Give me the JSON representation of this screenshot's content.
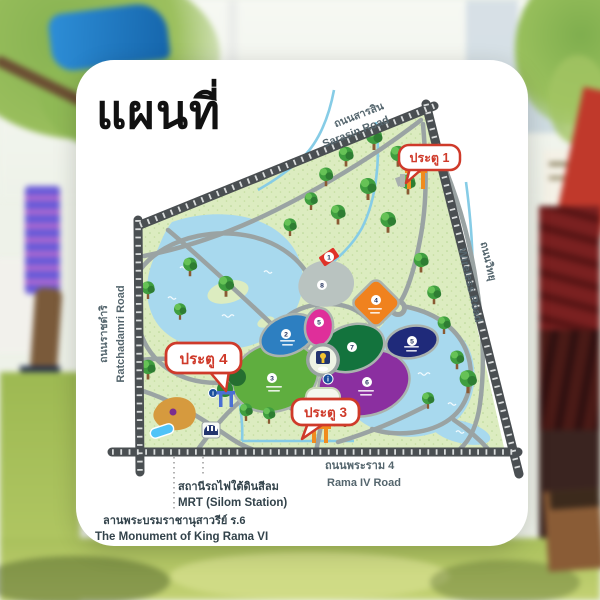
{
  "title": "แผนที่",
  "map": {
    "roads": {
      "sarasin_th": "ถนนสารสิน",
      "sarasin_en": "Sarasin Road",
      "wireless_th": "ถนนวิทยุ",
      "wireless_en": "Wireless Road",
      "ratchadamri_th": "ถนนราชดำริ",
      "ratchadamri_en": "Ratchadamri Road",
      "rama4_th": "ถนนพระราม 4",
      "rama4_en": "Rama IV Road"
    },
    "gates": {
      "gate1": "ประตู 1",
      "gate3": "ประตู 3",
      "gate4": "ประตู 4"
    },
    "landmarks": {
      "mrt_th": "สถานีรถไฟใต้ดินสีลม",
      "mrt_en": "MRT (Silom Station)",
      "monument_th": "ลานพระบรมราชานุสาวรีย์ ร.6",
      "monument_en": "The Monument of King Rama VI"
    },
    "zone_numbers": [
      {
        "id": "red-marker",
        "n": "1"
      },
      {
        "id": "pond",
        "n": "8"
      },
      {
        "id": "zone-blue",
        "n": "2"
      },
      {
        "id": "zone-pink",
        "n": "5"
      },
      {
        "id": "zone-darkgreen",
        "n": "7"
      },
      {
        "id": "zone-orange",
        "n": "4"
      },
      {
        "id": "zone-navy",
        "n": "5"
      },
      {
        "id": "zone-lightgreen",
        "n": "3"
      },
      {
        "id": "zone-purple",
        "n": "6"
      }
    ],
    "colors": {
      "badge_red": "#cf3a2a",
      "park_green": "#dcecc0",
      "lake_blue": "#a8d9ee",
      "road_border": "#4a4f52",
      "road_inner": "#9aa3a3",
      "gate_orange": "#f08c1e",
      "gate4_blue": "#4a6fd4"
    }
  }
}
